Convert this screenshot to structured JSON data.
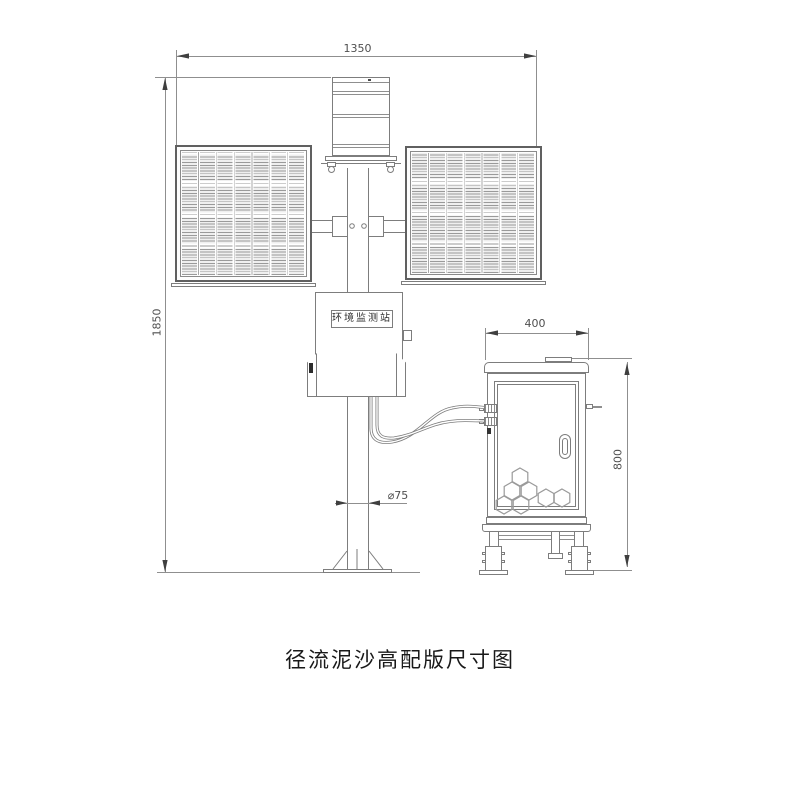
{
  "caption": "径流泥沙高配版尺寸图",
  "station": {
    "nameplate": "环境监测站"
  },
  "dimensions": {
    "overall_width": "1350",
    "overall_height": "1850",
    "cabinet_width": "400",
    "cabinet_height": "800",
    "pole_diameter": "⌀75"
  },
  "colors": {
    "background": "#ffffff",
    "object_line": "#7d7d7d",
    "dimension_line": "#8f8f8f",
    "caption_text": "#191919"
  }
}
